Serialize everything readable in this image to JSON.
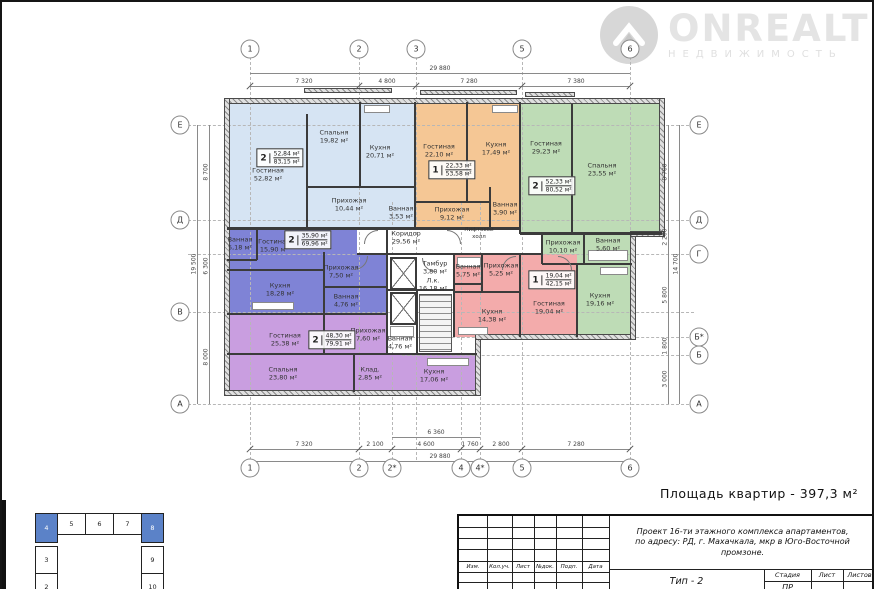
{
  "watermark": {
    "brand": "ONREALT",
    "tagline": "НЕДВИЖИМОСТЬ"
  },
  "summary_label": "Площадь квартир - 397,3 м²",
  "axes": {
    "top": [
      "1",
      "2",
      "3",
      "5",
      "6"
    ],
    "bottom": [
      "1",
      "2",
      "2*",
      "4",
      "4*",
      "5",
      "6"
    ],
    "left": [
      "Е",
      "Д",
      "В",
      "А"
    ],
    "right": [
      "Е",
      "Д",
      "Г",
      "Б*",
      "Б",
      "А"
    ]
  },
  "dims": {
    "top_total": "29 880",
    "top_seg": [
      "7 320",
      "4 800",
      "7 280",
      "7 380"
    ],
    "bottom_seg": [
      "7 320",
      "2 100",
      "4 600",
      "1 760",
      "2 800",
      "7 280"
    ],
    "bottom_sub": "6 360",
    "bottom_total": "29 880",
    "left_seg": [
      "8 700",
      "6 300",
      "8 000"
    ],
    "left_total": "19 500",
    "right_seg": [
      "8 700",
      "2 200",
      "5 800",
      "1 800",
      "3 000"
    ],
    "right_total": "14 700"
  },
  "apartments": {
    "lightblue": {
      "tag": {
        "num": "2",
        "top": "52,84 м²",
        "bot": "83,15 м²"
      },
      "rooms": {
        "living": "Гостиная\n52,82 м²",
        "bedroom": "Спальня\n19,82 м²",
        "kitchen": "Кухня\n20,71 м²",
        "hall": "Прихожая\n10,44 м²",
        "bath": "Ванная\n3,53 м²"
      }
    },
    "orange": {
      "tag": {
        "num": "1",
        "top": "22,33 м²",
        "bot": "53,58 м²"
      },
      "rooms": {
        "living": "Гостиная\n22,10 м²",
        "kitchen": "Кухня\n17,49 м²",
        "hall": "Прихожая\n9,12 м²",
        "bath": "Ванная\n3,90 м²"
      }
    },
    "green": {
      "tag": {
        "num": "2",
        "top": "52,33 м²",
        "bot": "80,52 м²"
      },
      "rooms": {
        "living": "Гостиная\n29,23 м²",
        "bedroom": "Спальня\n23,55 м²",
        "hall": "Прихожая\n10,10 м²",
        "bath": "Ванная\n5,60 м²",
        "kitchen": "Кухня\n19,16 м²"
      }
    },
    "violet": {
      "tag": {
        "num": "2",
        "top": "35,90 м²",
        "bot": "69,96 м²"
      },
      "rooms": {
        "bath1": "Ванная\n5,18 м²",
        "living": "Гостиная\n15,90 м²",
        "hall": "Прихожая\n7,50 м²",
        "kitchen": "Кухня\n18,28 м²",
        "bath2": "Ванная\n4,76 м²"
      }
    },
    "purple": {
      "tag": {
        "num": "2",
        "top": "48,30 м²",
        "bot": "79,91 м²"
      },
      "rooms": {
        "living": "Гостиная\n25,38 м²",
        "hall": "Прихожая\n7,60 м²",
        "bedroom": "Спальня\n23,80 м²",
        "storage": "Клад.\n2,85 м²",
        "kitchen": "Кухня\n17,06 м²"
      }
    },
    "pink": {
      "tag": {
        "num": "1",
        "top": "19,04 м²",
        "bot": "42,15 м²"
      },
      "rooms": {
        "bath": "Ванная\n5,75 м²",
        "hall": "Прихожая\n5,25 м²",
        "living": "Гостиная\n19,04 м²",
        "kitchen": "Кухня\n14,38 м²"
      }
    }
  },
  "core": {
    "corridor": "Коридор\n29,56 м²",
    "lift_hall": "Лифтовой\nхолл",
    "tambour": "Тамбур\n3,80 м²",
    "stair": "Л.к.\n16,18 м²",
    "bath": "Ванная\n4,76 м²"
  },
  "key_plan": {
    "top": [
      "4",
      "5",
      "6",
      "7",
      "8"
    ],
    "left": [
      "3",
      "2"
    ],
    "right": [
      "9",
      "10"
    ]
  },
  "title_block": {
    "project_line1": "Проект 16-ти этажного комплекса апартаментов,",
    "project_line2": "по адресу: РД, г. Махачкала, мкр в Юго-Восточной промзоне.",
    "type_label": "Тип - 2",
    "col_izm": "Изм.",
    "col_koluch": "Кол.уч.",
    "col_list": "Лист",
    "col_ndok": "№док.",
    "col_podp": "Подп.",
    "col_data": "Дата",
    "stage_header": "Стадия",
    "sheet_header": "Лист",
    "sheets_header": "Листов",
    "stage_value": "ПР"
  }
}
